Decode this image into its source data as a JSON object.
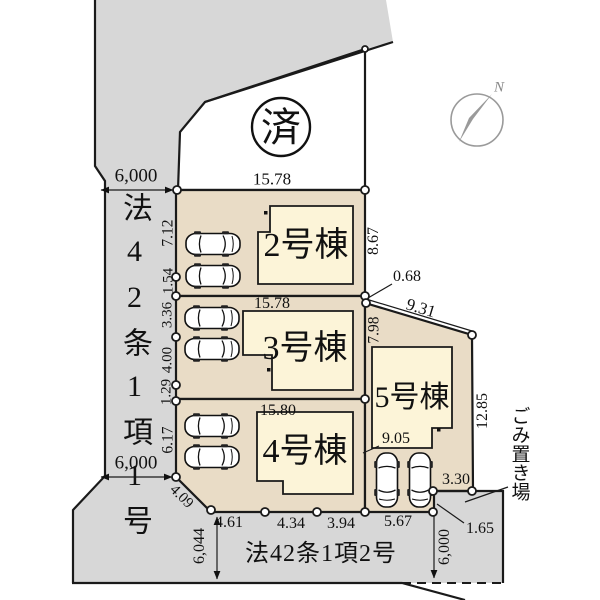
{
  "labels": {
    "lot2": "2号棟",
    "lot3": "3号棟",
    "lot4": "4号棟",
    "lot5": "5号棟",
    "sold": "済",
    "north": "N",
    "road_left": "法42条1項1号",
    "road_bottom": "法42条1項2号",
    "garbage": "ごみ置き場"
  },
  "dims": {
    "road_top_width": "6,000",
    "lot2_top": "15.78",
    "lot2_left": "7.12",
    "seg_1_54": "1.54",
    "seg_3_36": "3.36",
    "seg_4_00": "4.00",
    "seg_1_29": "1.29",
    "seg_6_17": "6.17",
    "road_left_width": "6,000",
    "seg_4_09": "4.09",
    "lot2_right": "8.67",
    "seg_0_68": "0.68",
    "lot5_diag": "9.31",
    "lot3_right": "7.98",
    "lot3_top": "15.78",
    "lot4_top": "15.80",
    "lot5_right": "12.85",
    "lot5_width": "9.05",
    "seg_3_30": "3.30",
    "seg_1_65": "1.65",
    "bottom_1": "4.61",
    "bottom_2": "4.34",
    "bottom_3": "3.94",
    "bottom_4": "5.67",
    "road_bottom_width_left": "6,044",
    "road_bottom_width_right": "6,000"
  },
  "colors": {
    "road": "#d7d7d7",
    "lot": "#e9dcc6",
    "building": "#fcf4d8",
    "line": "#1a1a1a",
    "compass": "#9a9a9a"
  }
}
